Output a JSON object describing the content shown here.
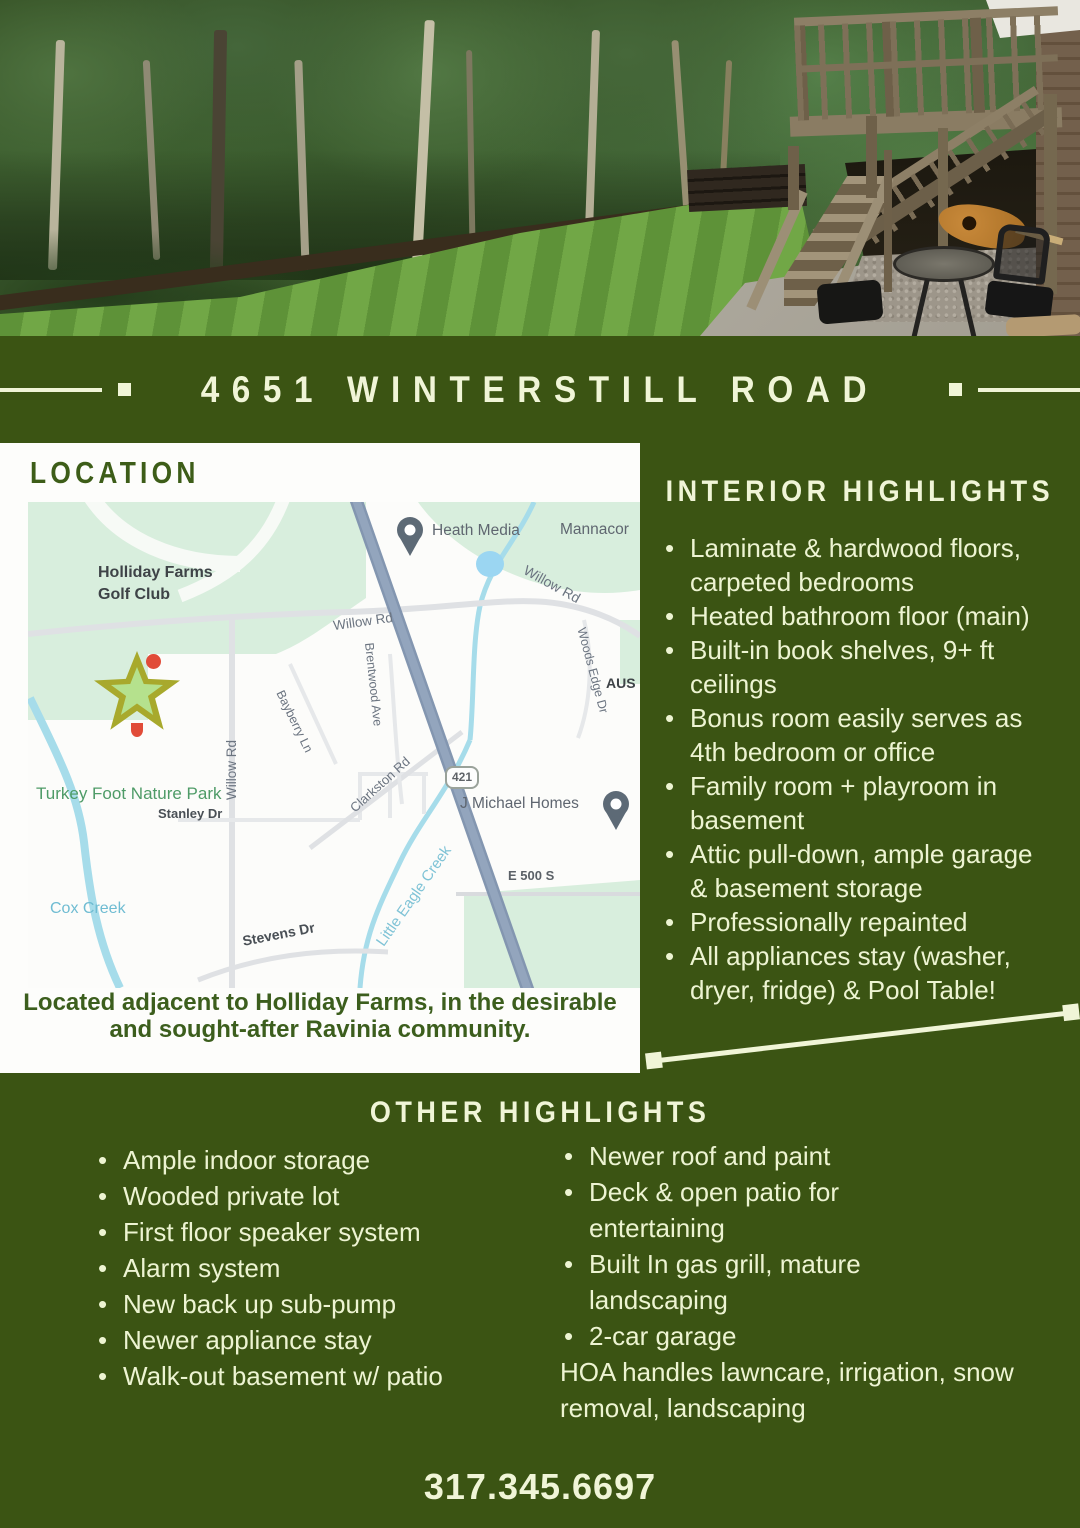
{
  "title": "4651 WINTERSTILL ROAD",
  "location": {
    "heading": "LOCATION",
    "caption": [
      "Located adjacent to Holliday Farms, in the desirable",
      "and sought-after Ravinia community."
    ],
    "map": {
      "golf_club": [
        "Holliday Farms",
        "Golf Club"
      ],
      "heath_media": "Heath Media",
      "mannacor": "Mannacor",
      "willow_rd_upper_left": "Willow Rd",
      "willow_rd_upper_right": "Willow Rd",
      "willow_rd_south": "Willow Rd",
      "woods_edge_dr": "Woods Edge Dr",
      "aus_partial": "AUS",
      "bayberry_ln": "Bayberry Ln",
      "brentwood_ave": "Brentwood Ave",
      "clarkston_rd": "Clarkston Rd",
      "route_shield": "421",
      "j_michael_homes": "J Michael Homes",
      "e_500_s": "E 500 S",
      "little_eagle_creek": "Little Eagle Creek",
      "turkey_foot_nature_park": "Turkey Foot Nature Park",
      "stanley_dr": "Stanley Dr",
      "cox_creek": "Cox Creek",
      "stevens_dr": "Stevens Dr"
    }
  },
  "interior": {
    "heading": "INTERIOR HIGHLIGHTS",
    "items": [
      "Laminate & hardwood floors, carpeted bedrooms",
      "Heated bathroom floor (main)",
      "Built-in book shelves, 9+ ft ceilings",
      "Bonus room easily serves as 4th bedroom or office",
      "Family room + playroom in basement",
      "Attic pull-down, ample garage & basement storage",
      "Professionally repainted",
      "All appliances stay (washer, dryer, fridge) & Pool Table!"
    ]
  },
  "other": {
    "heading": "OTHER HIGHLIGHTS",
    "left_items": [
      "Ample indoor storage",
      "Wooded private lot",
      "First floor speaker system",
      "Alarm system",
      "New back up sub-pump",
      "Newer appliance stay",
      "Walk-out basement w/ patio"
    ],
    "right_items": [
      "Newer roof and paint",
      "Deck & open patio for entertaining",
      "Built In gas grill, mature landscaping",
      "2-car garage"
    ],
    "note": "HOA handles lawncare, irrigation, snow removal, landscaping"
  },
  "phone": "317.345.6697",
  "colors": {
    "background_green": "#3b5413",
    "cream_text": "#f0f5d7",
    "heading_green_on_white": "#3d5d18",
    "map_park_green": "#d8eedd",
    "map_highway_blue": "#8396b0",
    "star_olive": "#a8a92c",
    "star_light_green": "#b5e18d"
  }
}
